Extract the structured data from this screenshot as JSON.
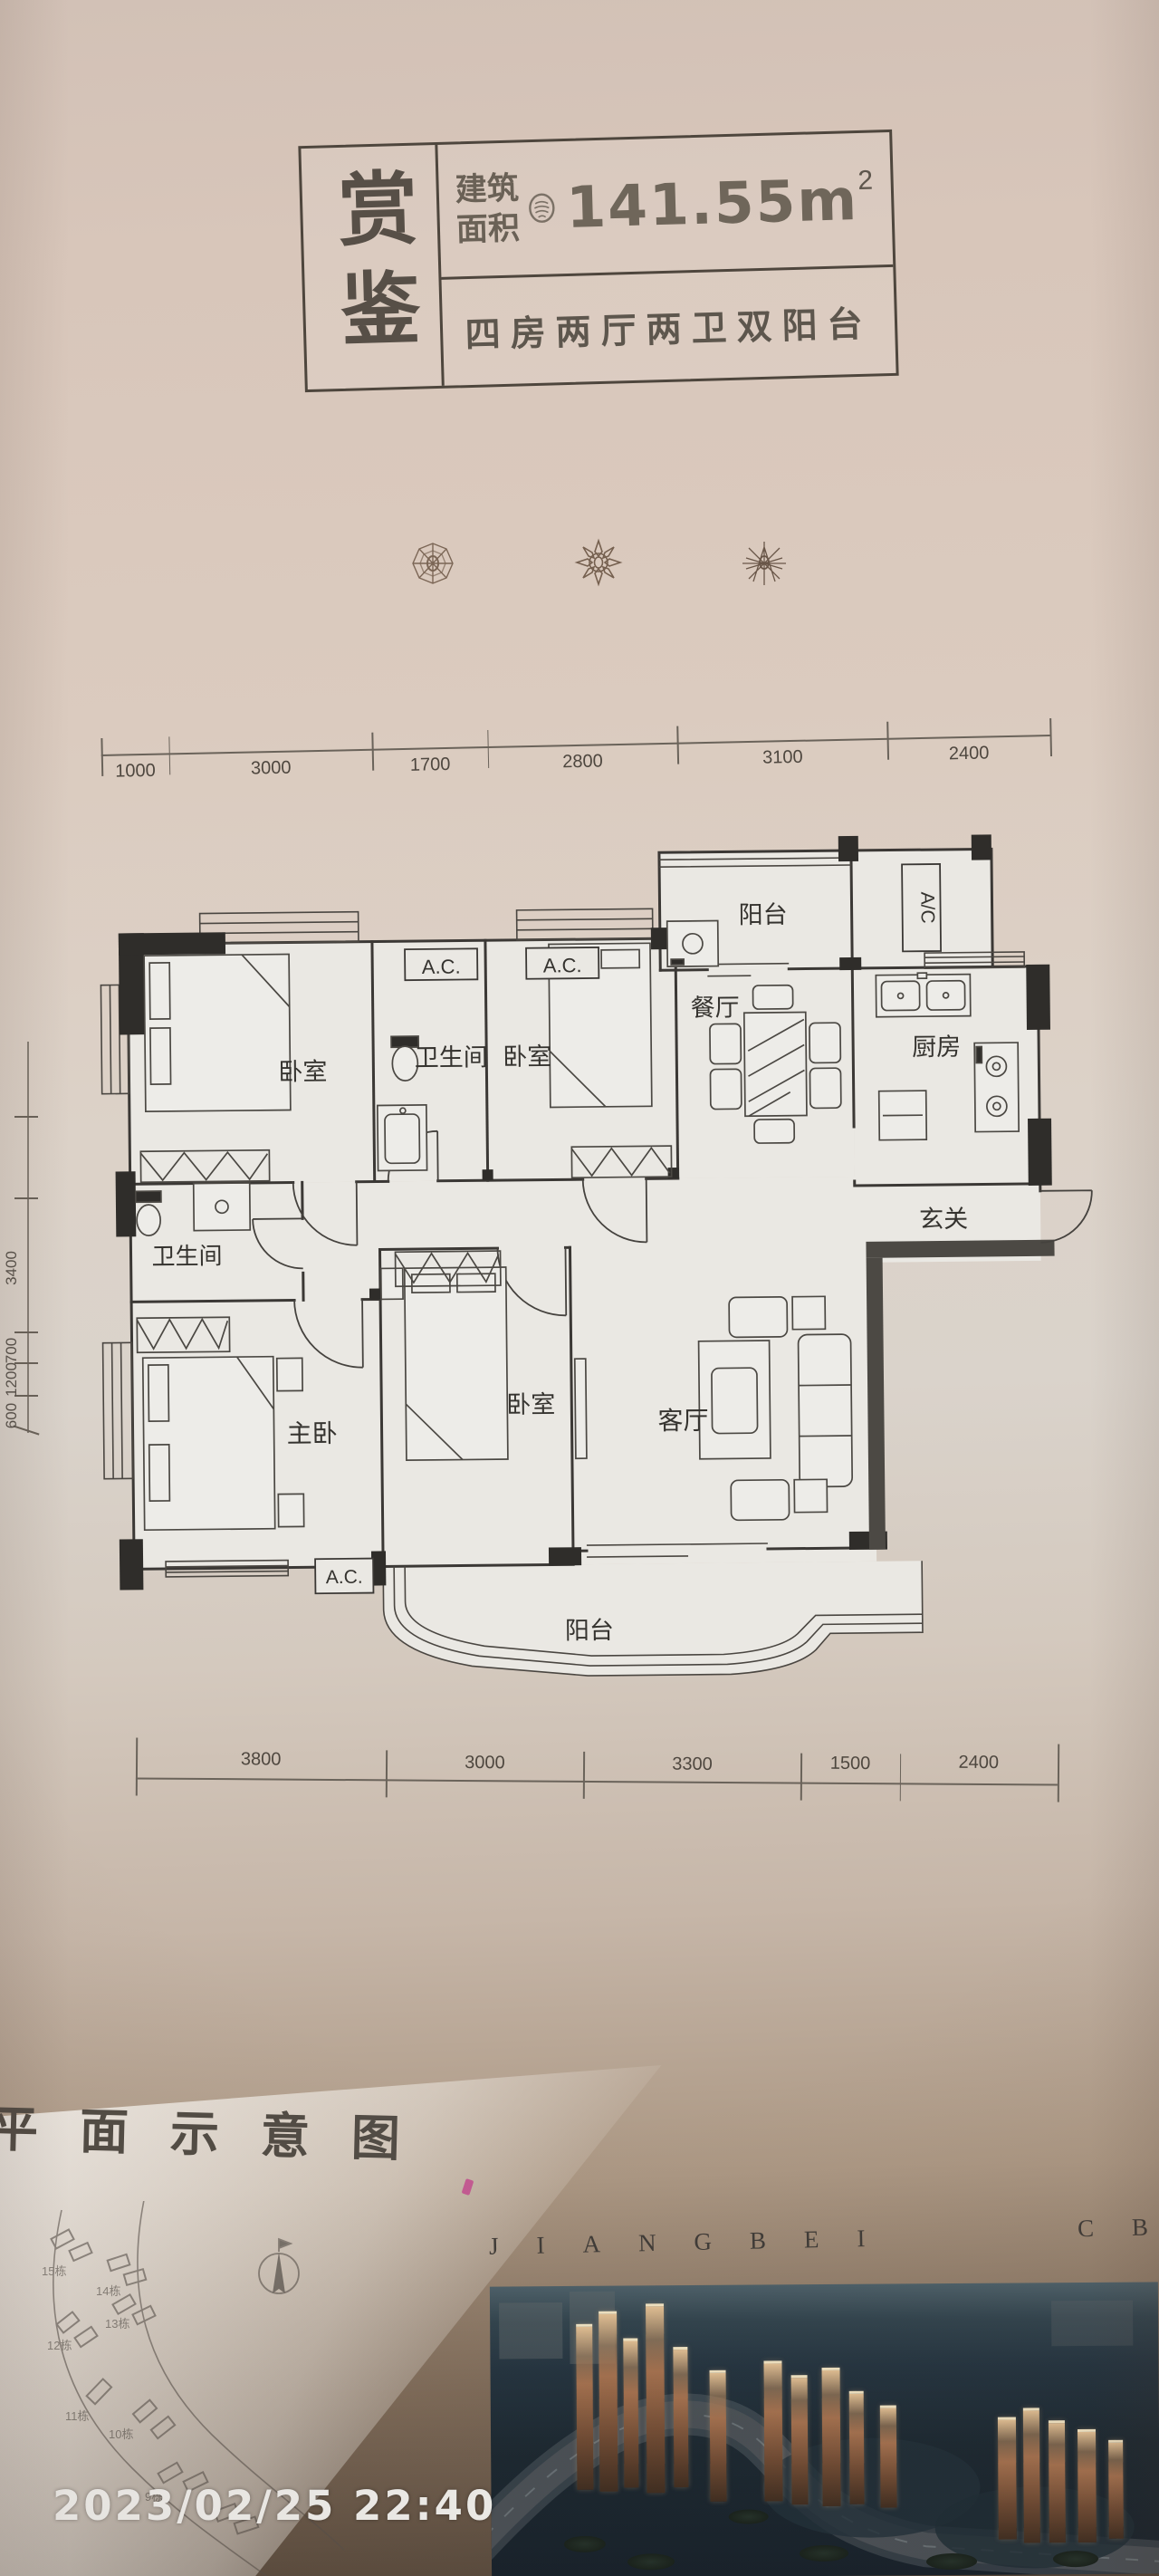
{
  "title_block": {
    "side_label": "赏鉴",
    "area_label_line1": "建筑",
    "area_label_line2": "面积",
    "area_value": "141.55m",
    "area_superscript": "2",
    "layout_description": "四房两厅两卫双阳台"
  },
  "dimensions": {
    "top": [
      "1000",
      "3000",
      "1700",
      "2800",
      "3100",
      "2400"
    ],
    "bottom": [
      "3800",
      "3000",
      "3300",
      "1500",
      "2400"
    ],
    "left": [
      "3400",
      "700",
      "1200",
      "600"
    ]
  },
  "floor_plan": {
    "rooms": {
      "bedroom_top_left": "卧室",
      "bathroom_top": "卫生间",
      "bedroom_top_middle": "卧室",
      "balcony_top": "阳台",
      "dining_room": "餐厅",
      "kitchen": "厨房",
      "foyer": "玄关",
      "bathroom_left": "卫生间",
      "master_bedroom": "主卧",
      "bedroom_bottom_middle": "卧室",
      "living_room": "客厅",
      "balcony_bottom": "阳台"
    },
    "ac_labels": {
      "top_1": "A.C.",
      "top_2": "A.C.",
      "right_column": "A/C",
      "bottom": "A.C."
    }
  },
  "footer": {
    "caption": "平面示意图",
    "brand_left": "JIANGBEI",
    "brand_right": "CB",
    "site_buildings": [
      "15栋",
      "14栋",
      "13栋",
      "12栋",
      "11栋",
      "10栋",
      "9栋"
    ],
    "timestamp": "2023/02/25 22:40"
  }
}
